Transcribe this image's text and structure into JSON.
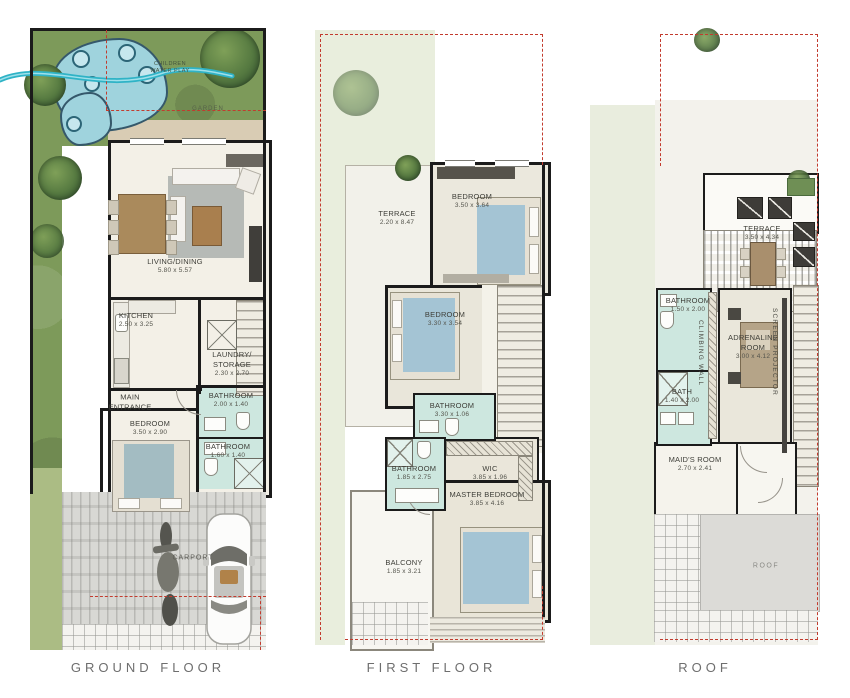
{
  "captions": {
    "ground": "GROUND FLOOR",
    "first": "FIRST FLOOR",
    "roof": "ROOF"
  },
  "colors": {
    "wall": "#1b1b1b",
    "grass": "#7d9a5a",
    "water": "#2fb3c6",
    "bathroom_floor": "#cde7df",
    "plot_dashed_line": "#c23b2e",
    "bed_blanket": "#a4c4d4",
    "caption_text": "#6e6e6e"
  },
  "ground_floor": {
    "water_feature_label_line1": "CHILDREN",
    "water_feature_label_line2": "WATER PLAY",
    "garden_label": "GARDEN",
    "living_dining": {
      "name": "LIVING/DINING",
      "dims": "5.80 x 5.57"
    },
    "kitchen": {
      "name": "KITCHEN",
      "dims": "2.50 x 3.25"
    },
    "laundry_storage": {
      "line1": "LAUNDRY/",
      "line2": "STORAGE",
      "dims": "2.30 x 2.70"
    },
    "main_entrance": {
      "line1": "MAIN",
      "line2": "ENTRANCE"
    },
    "bedroom": {
      "name": "BEDROOM",
      "dims": "3.50 x 2.90"
    },
    "bathroom_top": {
      "name": "BATHROOM",
      "dims": "2.00 x 1.40"
    },
    "bathroom_bottom": {
      "name": "BATHROOM",
      "dims": "1.60 x 1.40"
    },
    "carport": {
      "name": "CARPORT"
    }
  },
  "first_floor": {
    "terrace": {
      "name": "TERRACE",
      "dims": "2.20 x 8.47"
    },
    "bedroom_top": {
      "name": "BEDROOM",
      "dims": "3.50 x 3.64"
    },
    "bedroom_middle": {
      "name": "BEDROOM",
      "dims": "3.30 x 3.54"
    },
    "bathroom_hall": {
      "name": "BATHROOM",
      "dims": "3.30 x 1.06"
    },
    "bathroom_master": {
      "name": "BATHROOM",
      "dims": "1.85 x 2.75"
    },
    "wic": {
      "name": "WIC",
      "dims": "3.85 x 1.96"
    },
    "master_bedroom": {
      "name": "MASTER BEDROOM",
      "dims": "3.85 x 4.16"
    },
    "balcony": {
      "name": "BALCONY",
      "dims": "1.85 x 3.21"
    }
  },
  "roof": {
    "terrace": {
      "name": "TERRACE",
      "dims": "3.50 x 4.34"
    },
    "bathroom": {
      "name": "BATHROOM",
      "dims": "1.50 x 2.00"
    },
    "climbing_wall_label": "CLIMBING WALL",
    "adrenaline_room": {
      "line1": "ADRENALINE",
      "line2": "ROOM",
      "dims": "3.00 x 4.12"
    },
    "screen_projector_label": "SCREEN PROJECTOR",
    "bath": {
      "name": "BATH",
      "dims": "1.40 x 2.00"
    },
    "maids_room": {
      "name": "MAID'S ROOM",
      "dims": "2.70 x 2.41"
    },
    "roof_area_label": "ROOF"
  }
}
